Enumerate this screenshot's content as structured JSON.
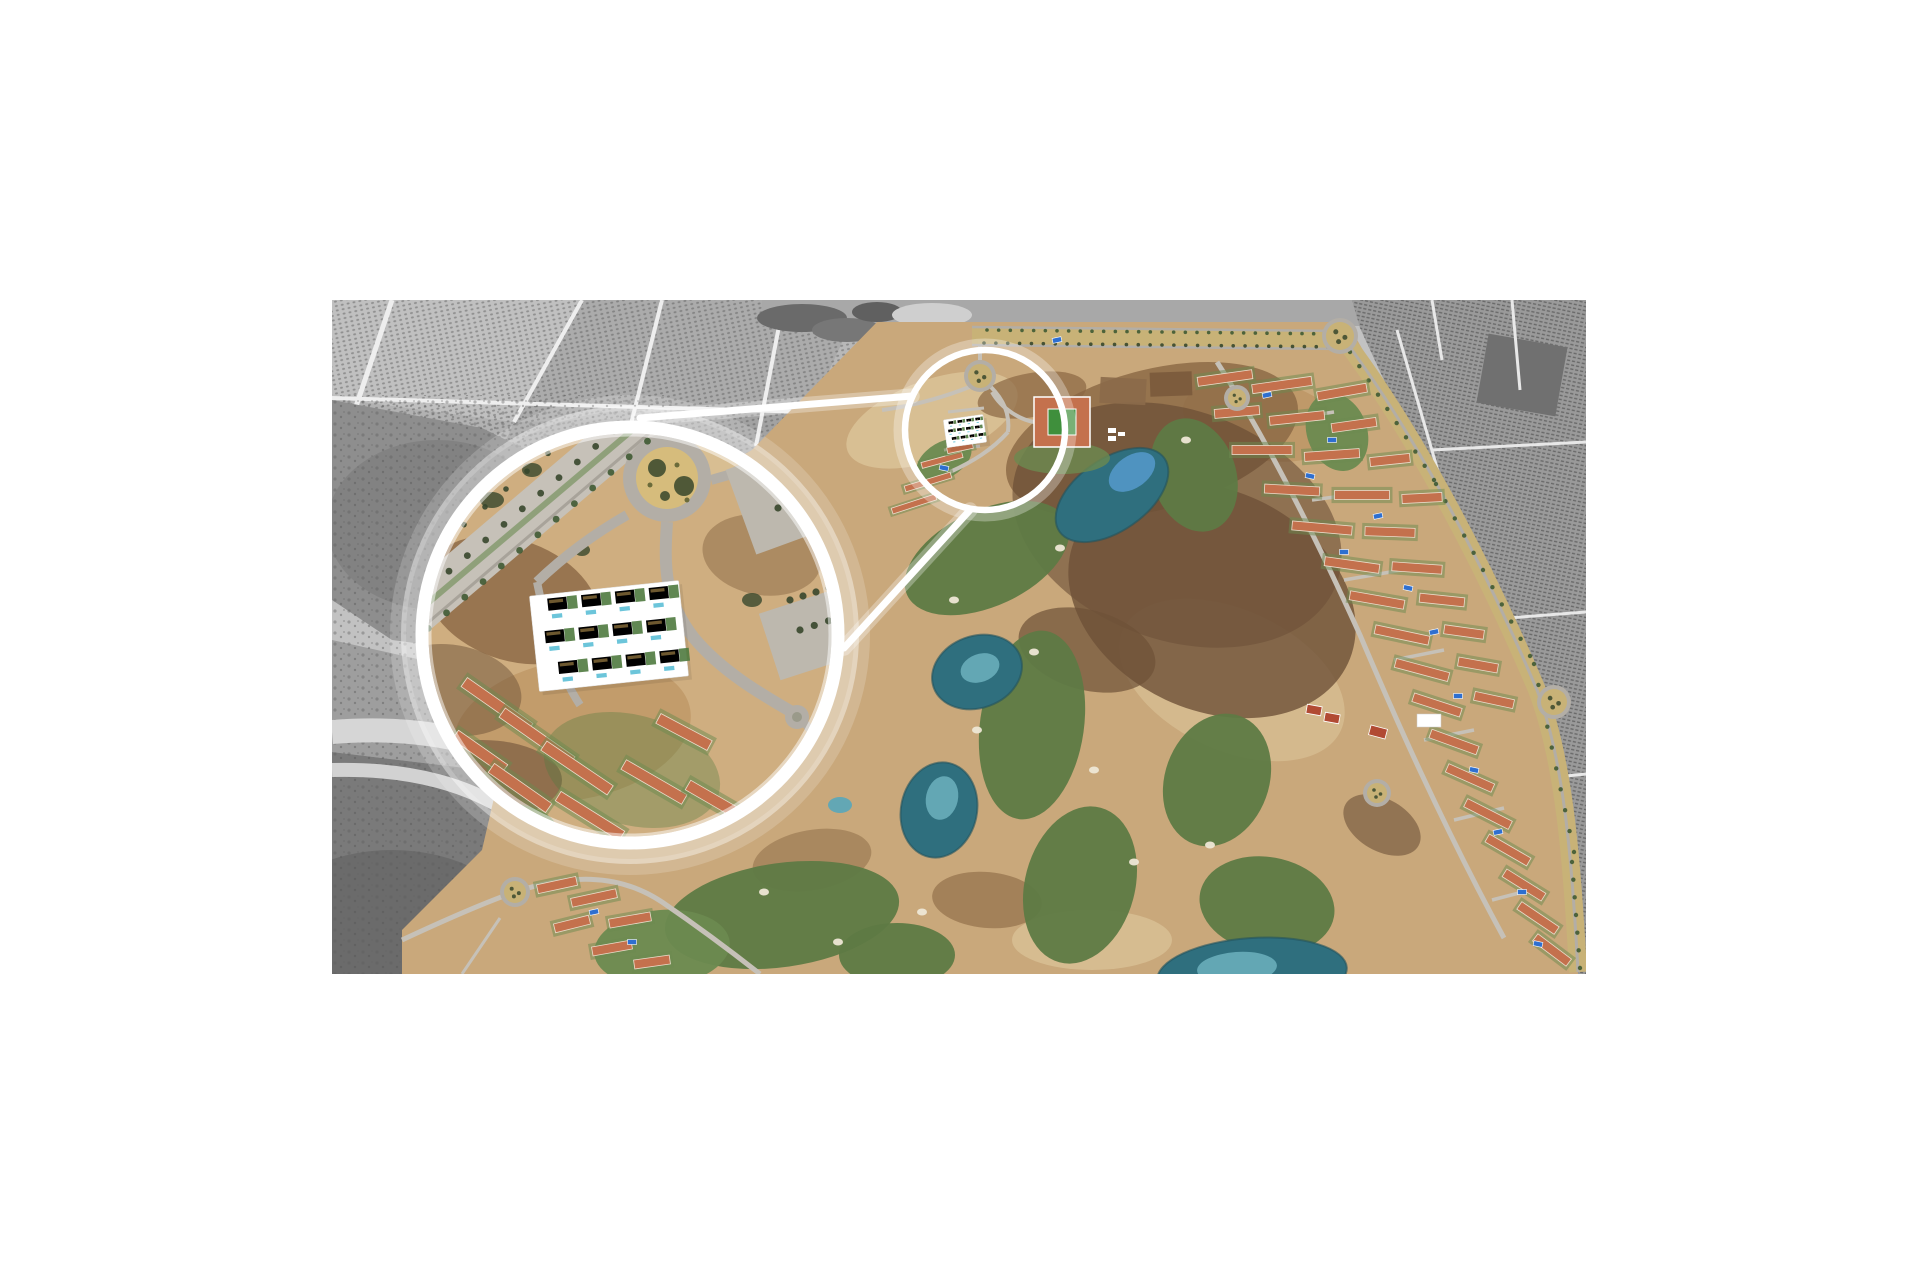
{
  "meta": {
    "alt_text": "Aerial photograph of a Spanish golf resort masterplan. Surrounding farmland is desaturated grayscale; the resort (golf fairways, teal ponds, terracotta-roofed townhouse rows, tree-lined avenues, roundabouts) is in colour. A large white magnifier circle enlarges a highlighted parcel of new-build apartments with pools; two white connector lines link it to a small white highlight ring over the source location near a roundabout."
  },
  "photo": {
    "left": 332,
    "top": 300,
    "width": 1254,
    "height": 674,
    "page_background": "#ffffff"
  },
  "palette": {
    "gray_base": "#c2c2c2",
    "gray_field": "#ababab",
    "gray_field2": "#b8b8b8",
    "gray_field3": "#a2a2a2",
    "gray_scrub": "#8e8e8e",
    "gray_scrub_dark": "#7a7a7a",
    "gray_darkest": "#696969",
    "gray_road": "#eeeeee",
    "gray_dot": "#4c4c4c",
    "gray_band": "#a8a8a8",
    "gray_right": "#9a9a9a",
    "sand": "#c9a87b",
    "sand_light": "#dcc49a",
    "sand_deep": "#b98f5e",
    "sand_mag": "#cfae80",
    "scrub_brown": "#8a6743",
    "scrub_dark": "#6e5138",
    "scrub_red": "#5e4430",
    "fairway": "#5e7a45",
    "fairway_light": "#6c8a50",
    "lawn": "#4f7a3f",
    "pond": "#2f6f7e",
    "pond_light": "#63a7b4",
    "pond_bright": "#4f93c0",
    "pool": "#2e6fd0",
    "pool_cyan": "#6cc5da",
    "roof": "#c4714d",
    "ridge": "#ecdccb",
    "court": "#b14a33",
    "hotel_green": "#3f8f3c",
    "road": "#b3aea6",
    "road_light": "#c6c1b8",
    "median": "#c8b277",
    "tree": "#3f5a33",
    "tree_dark": "#37472c",
    "bunker": "#eee7d6",
    "white": "#ffffff"
  },
  "legend": {
    "fairways": "[cx,cy,rx,ry,rotationDeg,isLight]",
    "ponds": "[cx,cy,rx,ry,rotationDeg,colorKey]",
    "patches": "[layerId,colorKey,cx,cy,rx,ry,rotationDeg,opacity]",
    "res_rows": "[x,y,rotationDeg,length] terracotta townhouse rows",
    "tree_lines": "[x1,y1,x2,y2,count,radius,colorKey]",
    "pools": "[x,y] bright blue swimming pools",
    "roundabouts": "[cx,cy,r]",
    "courts": "[x,y,w,h,rotationDeg] tennis courts",
    "lines": "[x1,y1,x2,y2,width] white magnifier connector lines"
  },
  "magnifier": {
    "big_circle": {
      "cx": 298,
      "cy": 335,
      "r": 208,
      "ring_width": 13
    },
    "small_circle": {
      "cx": 653,
      "cy": 130,
      "r": 80,
      "ring_width": 6.5
    },
    "lines": [
      [
        308,
        118,
        580,
        96,
        7
      ],
      [
        512,
        348,
        638,
        210,
        7
      ]
    ]
  },
  "fairways": [
    [
      655,
      258,
      88,
      48,
      -25,
      0
    ],
    [
      700,
      425,
      52,
      95,
      8,
      0
    ],
    [
      748,
      585,
      55,
      80,
      15,
      0
    ],
    [
      862,
      175,
      42,
      58,
      -18,
      0
    ],
    [
      885,
      480,
      52,
      68,
      20,
      0
    ],
    [
      935,
      605,
      68,
      48,
      10,
      0
    ],
    [
      450,
      615,
      118,
      52,
      -8,
      0
    ],
    [
      330,
      648,
      68,
      38,
      -5,
      1
    ],
    [
      565,
      655,
      58,
      32,
      0,
      0
    ],
    [
      612,
      160,
      30,
      18,
      -30,
      1
    ],
    [
      1005,
      132,
      30,
      40,
      -20,
      1
    ]
  ],
  "ponds": [
    [
      780,
      195,
      64,
      36,
      -35,
      "pond"
    ],
    [
      800,
      172,
      26,
      16,
      -35,
      "pond_bright"
    ],
    [
      645,
      372,
      46,
      36,
      -20,
      "pond"
    ],
    [
      648,
      368,
      20,
      14,
      -20,
      "pond_light"
    ],
    [
      607,
      510,
      38,
      48,
      12,
      "pond"
    ],
    [
      610,
      498,
      16,
      22,
      12,
      "pond_light"
    ],
    [
      920,
      674,
      95,
      36,
      -4,
      "pond"
    ],
    [
      905,
      668,
      40,
      16,
      -4,
      "pond_light"
    ],
    [
      508,
      505,
      12,
      8,
      0,
      "pond_light"
    ]
  ],
  "bunkers": [
    [
      622,
      300
    ],
    [
      702,
      352
    ],
    [
      762,
      470
    ],
    [
      802,
      562
    ],
    [
      878,
      545
    ],
    [
      432,
      592
    ],
    [
      506,
      642
    ],
    [
      854,
      140
    ],
    [
      645,
      430
    ],
    [
      728,
      248
    ],
    [
      590,
      612
    ]
  ],
  "patches": [
    [
      "g-patches",
      "sand_light",
      600,
      120,
      90,
      40,
      -20,
      0.8
    ],
    [
      "g-patches",
      "sand_light",
      900,
      380,
      120,
      70,
      25,
      0.6
    ],
    [
      "g-patches",
      "sand_light",
      760,
      640,
      80,
      30,
      0,
      0.7
    ],
    [
      "g-patches",
      "sand_deep",
      930,
      120,
      80,
      40,
      10,
      0.6
    ],
    [
      "g-patches",
      "scrub_brown",
      820,
      140,
      150,
      70,
      -15,
      0.8
    ],
    [
      "g-patches",
      "scrub_red",
      845,
      225,
      170,
      115,
      20,
      0.55
    ],
    [
      "g-patches",
      "scrub_dark",
      880,
      300,
      150,
      110,
      25,
      0.8
    ],
    [
      "g-patches",
      "scrub_brown",
      700,
      95,
      55,
      22,
      -10,
      0.7
    ],
    [
      "g-patches",
      "scrub_dark",
      755,
      350,
      70,
      40,
      15,
      0.7
    ],
    [
      "g-patches",
      "scrub_brown",
      655,
      600,
      55,
      28,
      5,
      0.6
    ],
    [
      "g-patches",
      "scrub_dark",
      1050,
      525,
      42,
      26,
      30,
      0.6
    ],
    [
      "g-patches",
      "scrub_brown",
      480,
      560,
      60,
      30,
      -10,
      0.5
    ],
    [
      "g-mag-patches",
      "scrub_brown",
      180,
      300,
      90,
      60,
      20,
      0.8
    ],
    [
      "g-mag-patches",
      "sand_deep",
      240,
      430,
      120,
      70,
      -10,
      0.6
    ],
    [
      "g-mag-patches",
      "scrub_dark",
      150,
      480,
      80,
      40,
      0,
      0.6
    ],
    [
      "g-mag-patches",
      "scrub_brown",
      430,
      255,
      60,
      40,
      10,
      0.5
    ],
    [
      "g-mag-patches",
      "sand_light",
      370,
      150,
      55,
      30,
      -20,
      0.7
    ],
    [
      "g-mag-patches",
      "scrub_dark",
      120,
      390,
      70,
      45,
      10,
      0.5
    ],
    [
      "g-mag-patches",
      "fairway_light",
      155,
      535,
      70,
      32,
      -5,
      0.9
    ],
    [
      "g-mag-patches",
      "fairway",
      250,
      565,
      60,
      28,
      0,
      0.9
    ],
    [
      "g-mag-patches",
      "lawn",
      300,
      470,
      90,
      55,
      15,
      0.35
    ],
    [
      "g-mag-patches",
      "tree_dark",
      160,
      200,
      12,
      8,
      0,
      0.8
    ],
    [
      "g-mag-patches",
      "tree_dark",
      200,
      170,
      10,
      7,
      0,
      0.8
    ],
    [
      "g-mag-patches",
      "tree_dark",
      390,
      140,
      12,
      8,
      0,
      0.8
    ],
    [
      "g-mag-patches",
      "tree_dark",
      420,
      300,
      10,
      7,
      0,
      0.8
    ],
    [
      "g-mag-patches",
      "tree_dark",
      250,
      250,
      8,
      6,
      0,
      0.8
    ]
  ],
  "res_rows": [
    [
      893,
      78,
      -8,
      55
    ],
    [
      950,
      85,
      -8,
      60
    ],
    [
      1010,
      92,
      -10,
      50
    ],
    [
      905,
      112,
      -5,
      45
    ],
    [
      965,
      118,
      -6,
      55
    ],
    [
      1022,
      125,
      -8,
      45
    ],
    [
      930,
      150,
      0,
      60
    ],
    [
      1000,
      155,
      -4,
      55
    ],
    [
      1058,
      160,
      -6,
      40
    ],
    [
      960,
      190,
      3,
      55
    ],
    [
      1030,
      195,
      0,
      55
    ],
    [
      1090,
      198,
      -3,
      40
    ],
    [
      990,
      228,
      5,
      60
    ],
    [
      1058,
      232,
      2,
      50
    ],
    [
      1020,
      265,
      8,
      55
    ],
    [
      1085,
      268,
      4,
      50
    ],
    [
      1045,
      300,
      10,
      55
    ],
    [
      1110,
      300,
      6,
      45
    ],
    [
      1070,
      335,
      12,
      55
    ],
    [
      1132,
      332,
      8,
      40
    ],
    [
      1090,
      370,
      15,
      55
    ],
    [
      1146,
      365,
      10,
      40
    ],
    [
      1105,
      405,
      18,
      50
    ],
    [
      1162,
      400,
      12,
      40
    ],
    [
      1122,
      442,
      20,
      50
    ],
    [
      1138,
      478,
      24,
      50
    ],
    [
      1156,
      514,
      27,
      50
    ],
    [
      1176,
      550,
      30,
      48
    ],
    [
      1192,
      585,
      32,
      46
    ],
    [
      1206,
      618,
      34,
      45
    ],
    [
      1220,
      650,
      37,
      42
    ],
    [
      225,
      585,
      -12,
      40
    ],
    [
      262,
      598,
      -12,
      46
    ],
    [
      298,
      620,
      -10,
      42
    ],
    [
      240,
      624,
      -14,
      36
    ],
    [
      280,
      648,
      -10,
      40
    ],
    [
      320,
      662,
      -8,
      36
    ]
  ],
  "mini_rows": [
    [
      610,
      160,
      -15,
      42
    ],
    [
      596,
      182,
      -17,
      48
    ],
    [
      582,
      204,
      -18,
      46
    ],
    [
      628,
      148,
      -12,
      26
    ]
  ],
  "mag_rows": [
    [
      165,
      405,
      35,
      80
    ],
    [
      205,
      437,
      35,
      85
    ],
    [
      245,
      468,
      34,
      80
    ],
    [
      148,
      452,
      35,
      60
    ],
    [
      188,
      488,
      35,
      70
    ],
    [
      258,
      516,
      32,
      75
    ],
    [
      322,
      482,
      30,
      70
    ],
    [
      352,
      432,
      28,
      58
    ],
    [
      382,
      500,
      30,
      60
    ],
    [
      118,
      520,
      36,
      55
    ]
  ],
  "pools": [
    [
      935,
      95
    ],
    [
      1000,
      140
    ],
    [
      978,
      176
    ],
    [
      1046,
      216
    ],
    [
      1012,
      252
    ],
    [
      1076,
      288
    ],
    [
      1102,
      332
    ],
    [
      1126,
      396
    ],
    [
      1142,
      470
    ],
    [
      1166,
      532
    ],
    [
      1190,
      592
    ],
    [
      1206,
      644
    ],
    [
      262,
      612
    ],
    [
      300,
      642
    ],
    [
      612,
      168
    ],
    [
      725,
      40
    ]
  ],
  "courts": [
    [
      982,
      410,
      15,
      9,
      10
    ],
    [
      1000,
      418,
      15,
      9,
      10
    ],
    [
      1046,
      432,
      17,
      10,
      15
    ]
  ],
  "sign": {
    "x": 1085,
    "y": 414,
    "w": 24,
    "h": 13
  },
  "roundabouts": [
    [
      1008,
      36,
      14
    ],
    [
      1222,
      402,
      13
    ],
    [
      648,
      76,
      12
    ],
    [
      183,
      592,
      11
    ],
    [
      905,
      98,
      9
    ],
    [
      1045,
      493,
      10
    ]
  ],
  "tree_lines": [
    [
      655,
      30,
      1005,
      34,
      30,
      1.8,
      "tree"
    ],
    [
      652,
      43,
      1008,
      47,
      30,
      1.8,
      "tree_dark"
    ],
    [
      1018,
      52,
      1102,
      180,
      9,
      2.2,
      "tree"
    ],
    [
      1104,
      184,
      1198,
      356,
      10,
      2.2,
      "tree"
    ],
    [
      1202,
      364,
      1242,
      552,
      9,
      2.2,
      "tree"
    ],
    [
      1240,
      562,
      1248,
      668,
      6,
      2.2,
      "tree"
    ],
    [
      62,
      318,
      337,
      84,
      15,
      3.4,
      "tree_dark"
    ],
    [
      78,
      344,
      352,
      110,
      15,
      3.4,
      "tree"
    ],
    [
      48,
      296,
      300,
      82,
      12,
      2.8,
      "tree_dark"
    ],
    [
      420,
      152,
      532,
      120,
      8,
      3.6,
      "tree_dark"
    ],
    [
      432,
      178,
      546,
      144,
      8,
      3.6,
      "tree_dark"
    ],
    [
      446,
      208,
      558,
      172,
      8,
      3.6,
      "tree_dark"
    ],
    [
      458,
      300,
      562,
      268,
      8,
      3.6,
      "tree_dark"
    ],
    [
      468,
      330,
      568,
      298,
      7,
      3.6,
      "tree_dark"
    ]
  ],
  "parcels": {
    "big": {
      "cx": 277,
      "cy": 336,
      "rot": -6,
      "w": 150,
      "h": 96,
      "colsX": [
        -64,
        -30,
        4,
        38
      ],
      "rowsY": [
        -44,
        -12,
        20
      ],
      "stagger": [
        6,
        0,
        10
      ],
      "u": {
        "bw": 20,
        "bh": 13,
        "lw": 10,
        "pw": 11,
        "ph": 5,
        "py": 16
      }
    },
    "mini": {
      "cx": 633,
      "cy": 131,
      "rot": -8,
      "w": 40,
      "h": 28,
      "colsX": [
        -17,
        -8,
        1,
        10
      ],
      "rowsY": [
        -12,
        -4,
        4
      ],
      "stagger": [
        1.5,
        0,
        2.5
      ],
      "u": {
        "bw": 5.5,
        "bh": 3.5,
        "lw": 2.5,
        "pw": 3,
        "ph": 1.6,
        "py": 4.5
      }
    }
  }
}
